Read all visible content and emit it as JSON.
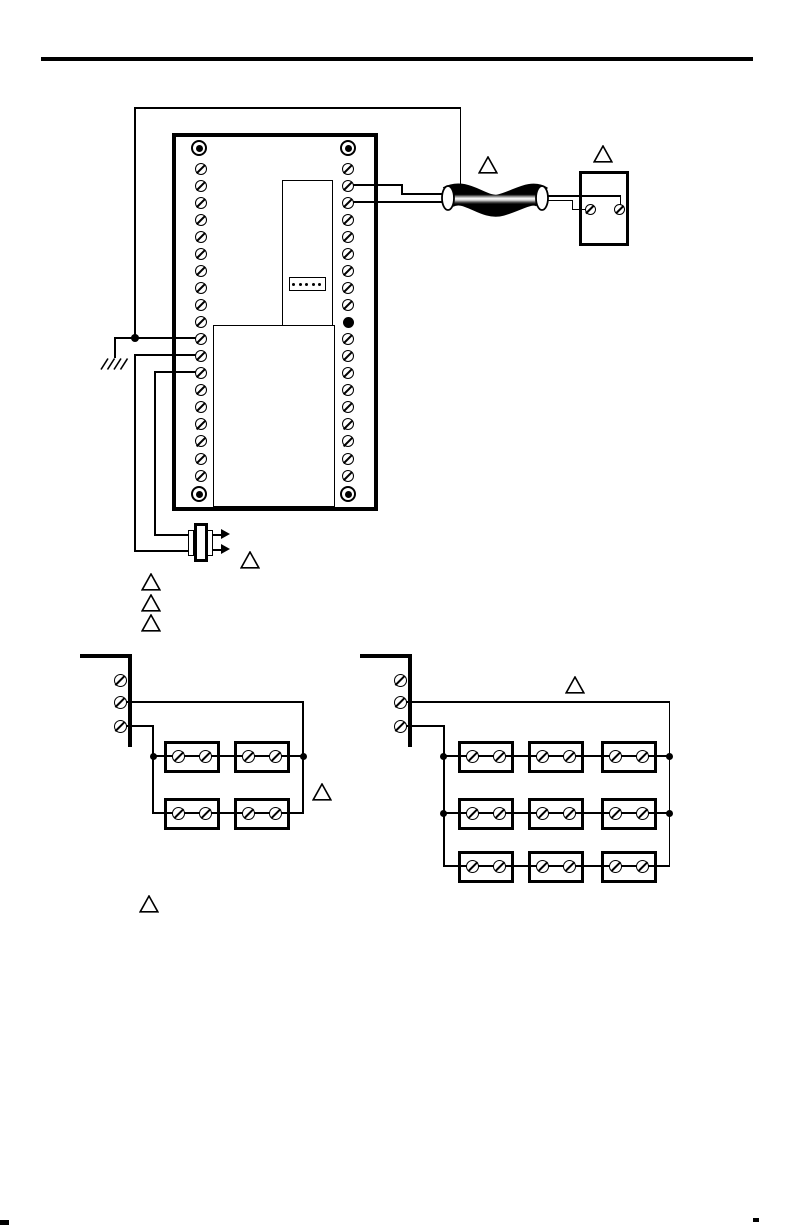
{
  "meta": {
    "kind": "wiring-diagram-page",
    "bg_color": "#ffffff",
    "ink_color": "#000000"
  },
  "header_rule": {
    "present": true
  },
  "controller": {
    "left_terminal_count": 19,
    "right_terminal_count": 19,
    "right_solid_dot_position": 10,
    "mounting_hole_count": 4,
    "header_connector_pin_count": 5
  },
  "shield_wire": {
    "grounded": true
  },
  "cable": {
    "type": "shielded-cable",
    "conductor_count": 2
  },
  "remote_device": {
    "terminal_count": 2
  },
  "sensor": {
    "type": "insertion-sensor",
    "lead_count": 2,
    "arrow_count": 2
  },
  "note_markers": {
    "shape": "triangle",
    "count": 9
  },
  "sensor_network_small": {
    "rows": 2,
    "columns": 2,
    "terminals_per_block": 2,
    "strip_terminal_count": 3
  },
  "sensor_network_large": {
    "rows": 3,
    "columns": 3,
    "terminals_per_block": 2,
    "strip_terminal_count": 3
  }
}
